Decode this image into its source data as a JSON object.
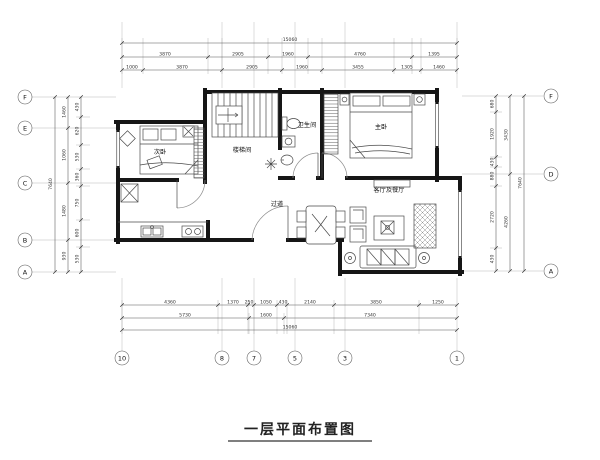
{
  "title": "一层平面布置图",
  "rooms": {
    "secondary_bedroom": "次卧",
    "stairwell": "楼梯间",
    "bathroom": "卫生间",
    "master_bedroom": "主卧",
    "corridor": "过道",
    "living_dining": "客厅及餐厅"
  },
  "grid_bubbles": {
    "left": [
      "F",
      "E",
      "C",
      "B",
      "A"
    ],
    "right": [
      "F",
      "D",
      "A"
    ],
    "bottom": [
      "10",
      "8",
      "7",
      "5",
      "3",
      "1"
    ]
  },
  "dimensions": {
    "top": {
      "total": "15060",
      "row2": [
        "3870",
        "2905",
        "1960",
        "4760",
        "1395"
      ],
      "row3": [
        "1000",
        "3870",
        "2905",
        "1960",
        "3455",
        "1305",
        "1460"
      ]
    },
    "bottom": {
      "row1": [
        "4360",
        "1370",
        "250",
        "1050",
        "430",
        "2140",
        "3850",
        "1250"
      ],
      "row2": [
        "5730",
        "1600",
        "7340"
      ],
      "total": "15060"
    },
    "left": {
      "total": "7640",
      "inner": [
        "1460",
        "1060",
        "1480",
        "930"
      ],
      "fine": [
        "430",
        "620",
        "530",
        "360",
        "750",
        "600",
        "530"
      ]
    },
    "right": {
      "total": "7640",
      "inner": [
        "3430",
        "4260"
      ],
      "fine": [
        "680",
        "1920",
        "430",
        "880",
        "2720",
        "430"
      ]
    }
  },
  "colors": {
    "ink": "#1a1a1a",
    "paper": "#ffffff"
  }
}
